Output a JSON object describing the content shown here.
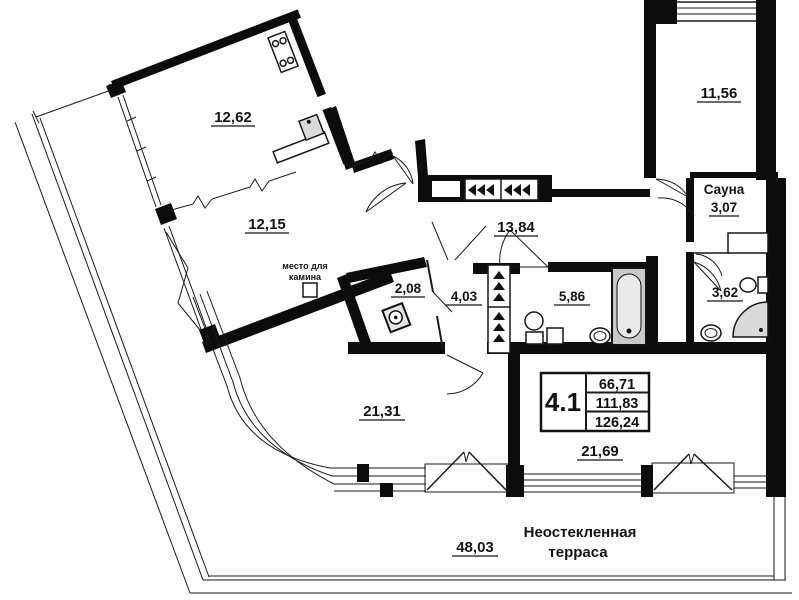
{
  "plan_type": "apartment-floor-plan",
  "labels": {
    "kitchen_area": "12,62",
    "living_area": "12,15",
    "hall_area": "13,84",
    "room_top_right_area": "11,56",
    "sauna_name": "Сауна",
    "sauna_area": "3,07",
    "storage_area": "2,08",
    "corridor_area": "4,03",
    "bathroom_area": "5,86",
    "wc_area": "3,62",
    "room_center_area": "21,31",
    "room_right_area": "21,69",
    "terrace_area": "48,03",
    "terrace_name_line1": "Неостекленная",
    "terrace_name_line2": "терраса",
    "fireplace_line1": "место для",
    "fireplace_line2": "камина"
  },
  "unit_info": {
    "unit_number": "4.1",
    "area_living": "66,71",
    "area_apartment": "111,83",
    "area_total": "126,24"
  },
  "colors": {
    "wall": "#0c0c0c",
    "background": "#ffffff",
    "fixture_gray": "#d9d9d9"
  }
}
